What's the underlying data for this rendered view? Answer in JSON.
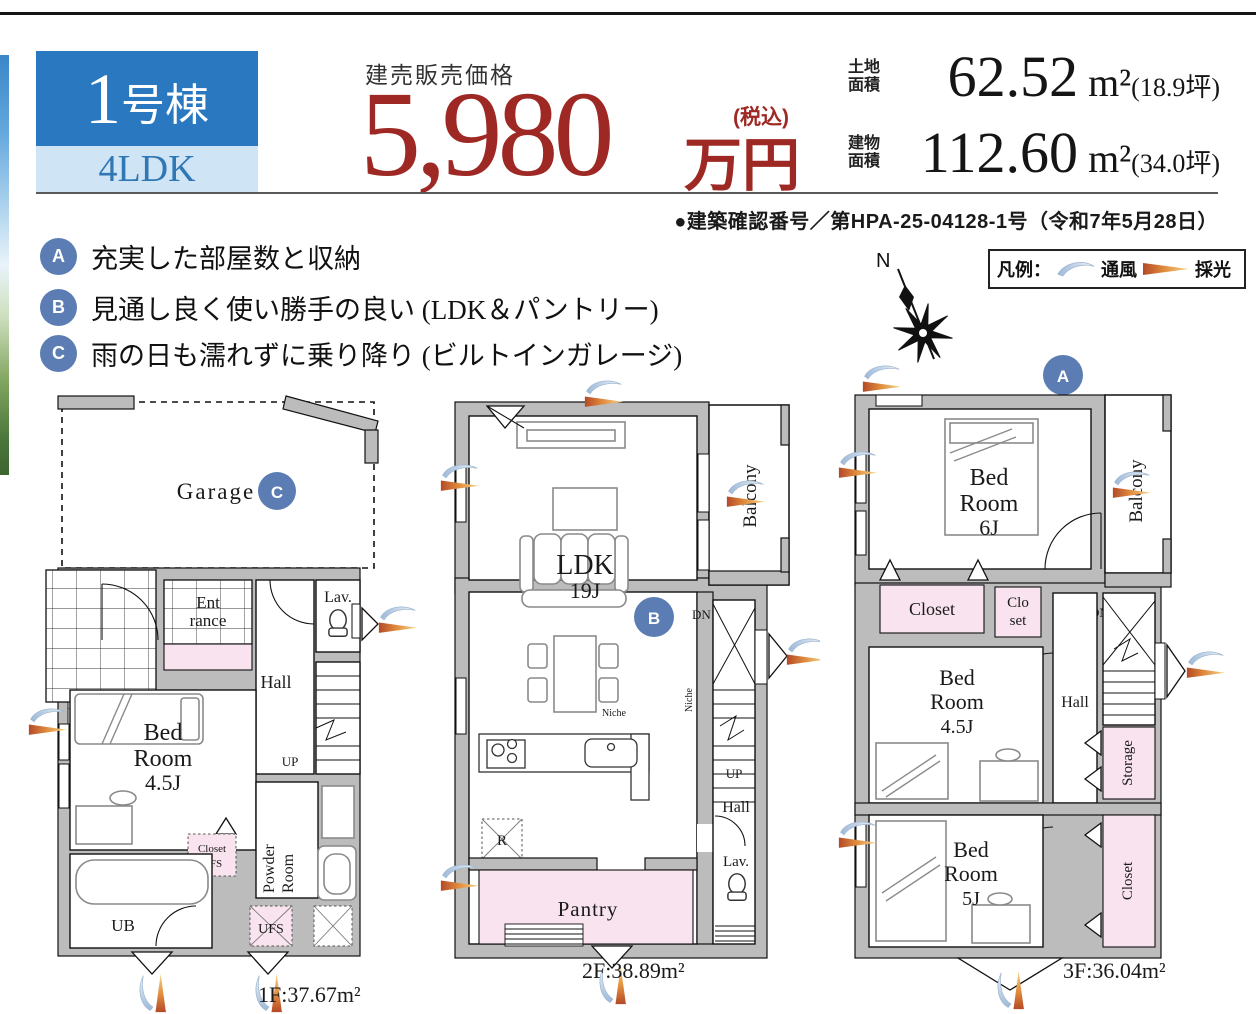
{
  "header": {
    "building_no_num": "1",
    "building_no_suffix": "号棟",
    "plan_type": "4LDK",
    "price_label": "建売販売価格",
    "price_value": "5,980",
    "price_tax_note": "(税込)",
    "price_unit": "万円",
    "land_label_line1": "土地",
    "land_label_line2": "面積",
    "land_value": "62.52",
    "land_unit": "m²",
    "land_tsubo": "(18.9坪)",
    "bldg_label_line1": "建物",
    "bldg_label_line2": "面積",
    "bldg_value": "112.60",
    "bldg_unit": "m²",
    "bldg_tsubo": "(34.0坪)",
    "confirmation": "●建築確認番号／第HPA-25-04128-1号（令和7年5月28日）"
  },
  "features": [
    {
      "marker": "A",
      "text": "充実した部屋数と収納"
    },
    {
      "marker": "B",
      "text": "見通し良く使い勝手の良い (LDK＆パントリー)"
    },
    {
      "marker": "C",
      "text": "雨の日も濡れずに乗り降り (ビルトインガレージ)"
    }
  ],
  "legend": {
    "title": "凡例：",
    "wind": "通風",
    "light": "採光"
  },
  "compass": {
    "north": "N"
  },
  "floor1": {
    "marker": "C",
    "area": "1F:37.67m²",
    "garage": "Garage",
    "ent1": "Ent",
    "ent2": "rance",
    "lav": "Lav.",
    "hall": "Hall",
    "up": "UP",
    "bed1": "Bed",
    "bed2": "Room",
    "bed3": "4.5J",
    "closet1": "Closet",
    "closet2": "UFS",
    "powder1": "Powder",
    "powder2": "Room",
    "ub": "UB",
    "ufs": "UFS"
  },
  "floor2": {
    "marker": "B",
    "area": "2F:38.89m²",
    "ldk1": "LDK",
    "ldk2": "19J",
    "balcony": "Balcony",
    "dn": "DN",
    "niche1": "Niche",
    "niche2": "Niche",
    "up": "UP",
    "hall": "Hall",
    "lav": "Lav.",
    "r": "R",
    "pantry": "Pantry"
  },
  "floor3": {
    "marker": "A",
    "area": "3F:36.04m²",
    "bed6_1": "Bed",
    "bed6_2": "Room",
    "bed6_3": "6J",
    "balcony": "Balcony",
    "closet": "Closet",
    "clo1": "Clo",
    "clo2": "set",
    "dn": "DN",
    "hall": "Hall",
    "bed45_1": "Bed",
    "bed45_2": "Room",
    "bed45_3": "4.5J",
    "storage": "Storage",
    "bed5_1": "Bed",
    "bed5_2": "Room",
    "bed5_3": "5J",
    "closet_r": "Closet"
  },
  "colors": {
    "accent_blue": "#2a79c0",
    "light_blue": "#cfe4f5",
    "price_red": "#9e2823",
    "marker_blue": "#5b7db3",
    "plan_pink": "#f8e3ee",
    "wall_gray": "#bcbcbc"
  }
}
